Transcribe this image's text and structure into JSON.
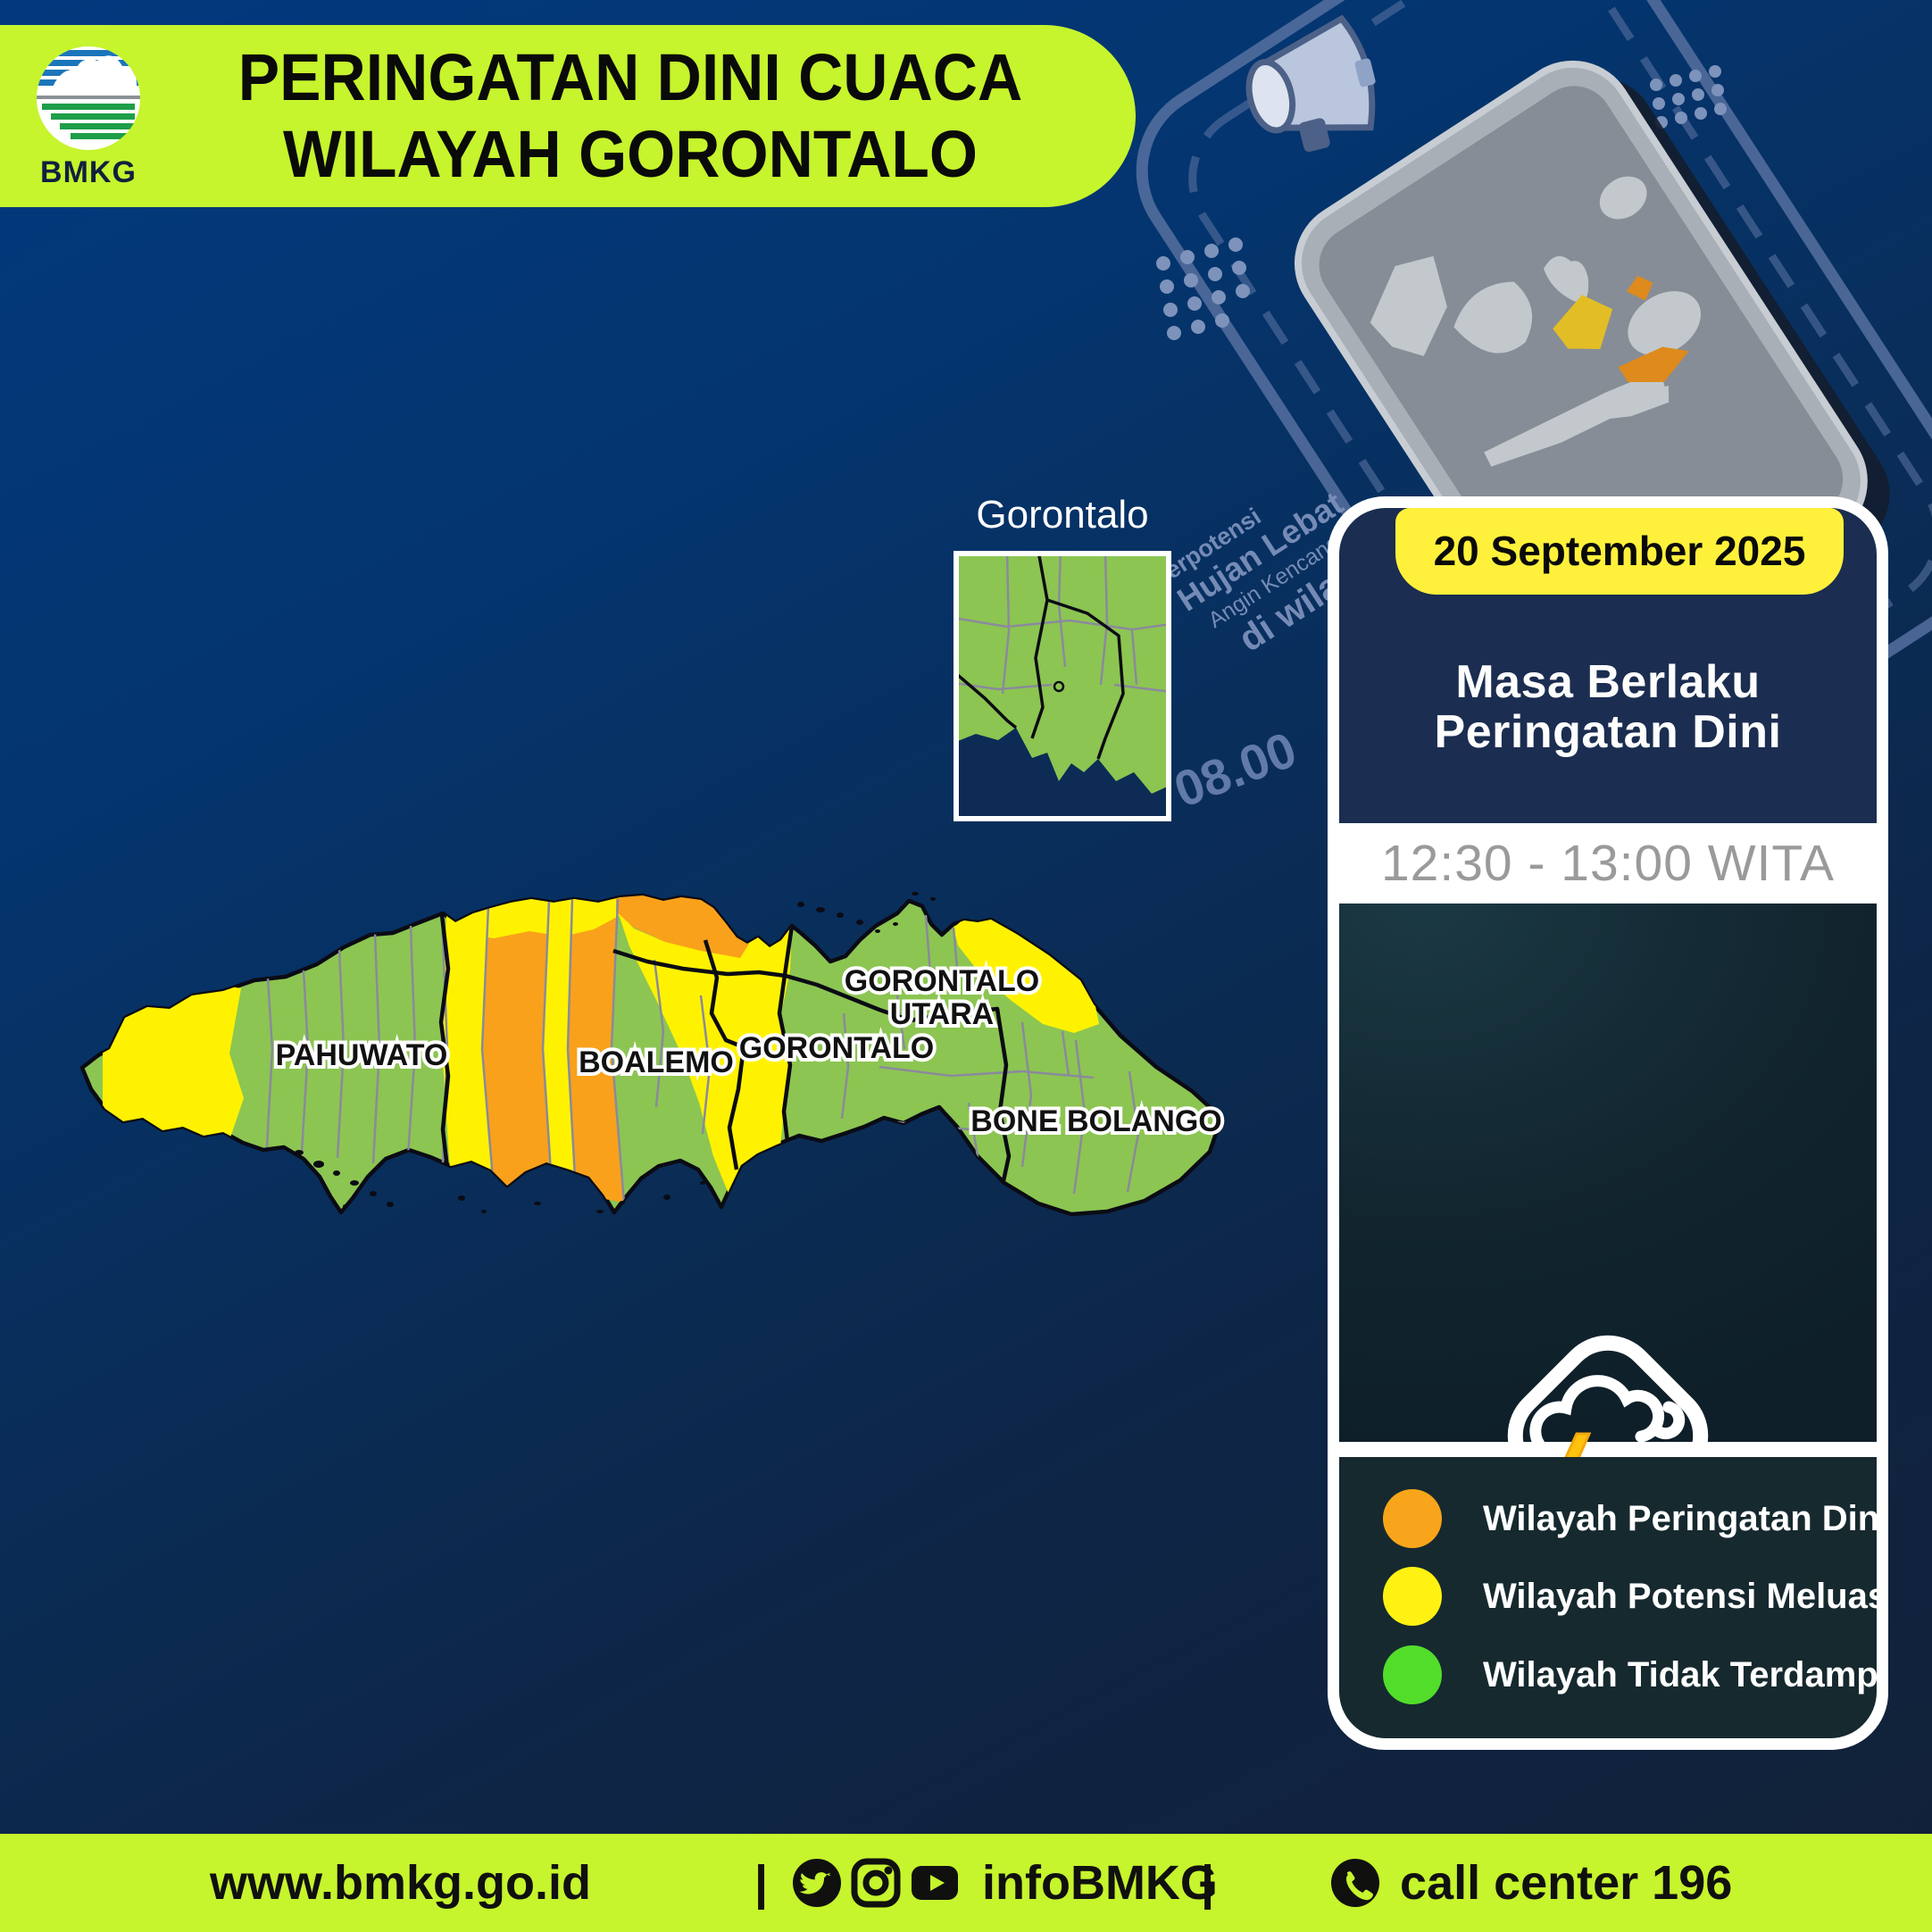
{
  "header": {
    "logo_text": "BMKG",
    "title_line1": "PERINGATAN DINI CUACA",
    "title_line2": "WILAYAH GORONTALO"
  },
  "promo_graphic": {
    "line1": "Berpotensi",
    "line2": "Hujan Lebat",
    "line3": "Angin Kencang",
    "line4": "di wilayah",
    "clock_start": "08.00",
    "clock_end": "11.00"
  },
  "inset_map": {
    "label": "Gorontalo"
  },
  "map": {
    "region_labels": {
      "pahuwato": "PAHUWATO",
      "boalemo": "BOALEMO",
      "gorontalo": "GORONTALO",
      "gorontalo_utara_line1": "GORONTALO",
      "gorontalo_utara_line2": "UTARA",
      "bone_bolango": "BONE BOLANGO"
    },
    "colors": {
      "warning_orange": "#F9A11B",
      "expansion_yellow": "#FFF200",
      "unaffected_green": "#8CC552",
      "sea_navy": "#0a2c55"
    }
  },
  "panel": {
    "date": "20 September 2025",
    "validity_line1": "Masa Berlaku",
    "validity_line2": "Peringatan Dini",
    "time_range": "12:30 - 13:00 WITA",
    "description_line1": "Potensi terjadi hujan dengan",
    "description_line2": "intensitas sedang hingga lebat",
    "description_line3": "yang dapat disertai kilat/petir dan",
    "description_line4": "angin kencang",
    "legend": [
      {
        "color": "#F9A51B",
        "label": "Wilayah Peringatan Dini"
      },
      {
        "color": "#FFF212",
        "label": "Wilayah Potensi Meluas"
      },
      {
        "color": "#52DD2B",
        "label": "Wilayah Tidak Terdampak"
      }
    ]
  },
  "footer": {
    "website": "www.bmkg.go.id",
    "separator": "|",
    "social_handle": "infoBMKG",
    "call_center": "call center 196"
  }
}
